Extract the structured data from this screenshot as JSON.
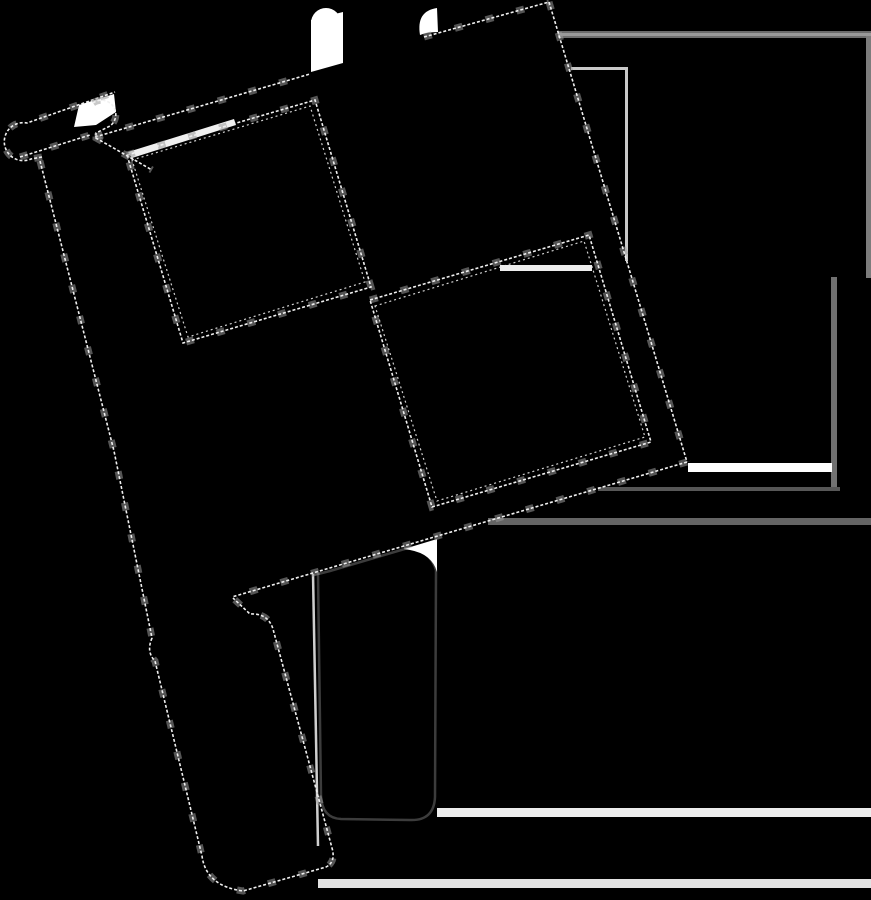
{
  "meta": {
    "description": "Black checkered racing flag icon silhouette on black background, tilted about 16 degrees, with pole, top clip, and two hanging straps; visible only via stepped light outlines, small white cutout blobs, thin light guide lines and gray background rules",
    "width": 871,
    "height": 900,
    "background": "#000000"
  },
  "icon": {
    "name": "checkered-flag",
    "fill": "#000000",
    "edge_fine_color": "#f0f0f0",
    "edge_block_color": "#9a9a9a",
    "strap_outline_color": "#3c3c3c",
    "tilt_degrees": 16.5
  },
  "shapes": [
    {
      "id": "background",
      "kind": "rect",
      "x": 0,
      "y": 0,
      "w": 871,
      "h": 900,
      "fill": "#000000"
    },
    {
      "id": "page-rule-top-dark",
      "kind": "rect",
      "x": 558,
      "y": 31,
      "w": 313,
      "h": 2,
      "fill": "#6b6b6b"
    },
    {
      "id": "page-rule-top-light",
      "kind": "rect",
      "x": 558,
      "y": 33,
      "w": 313,
      "h": 3,
      "fill": "#999999"
    },
    {
      "id": "page-rule-top-shade",
      "kind": "rect",
      "x": 558,
      "y": 36,
      "w": 313,
      "h": 2,
      "fill": "#6f6f6f"
    },
    {
      "id": "page-rule-right-upper",
      "kind": "rect",
      "x": 866,
      "y": 36,
      "w": 5,
      "h": 242,
      "fill": "#7c7c7c"
    },
    {
      "id": "page-rule-right-inner",
      "kind": "rect",
      "x": 831,
      "y": 277,
      "w": 6,
      "h": 213,
      "fill": "#717171"
    },
    {
      "id": "page-rule-bottom",
      "kind": "rect",
      "x": 488,
      "y": 518,
      "w": 383,
      "h": 7,
      "fill": "#646464"
    },
    {
      "id": "page-rule-inner-h",
      "kind": "rect",
      "x": 598,
      "y": 487,
      "w": 242,
      "h": 4,
      "fill": "#575757"
    },
    {
      "id": "page-stripe-upper",
      "kind": "rect",
      "x": 437,
      "y": 808,
      "w": 434,
      "h": 9,
      "fill": "#ededed"
    },
    {
      "id": "page-stripe-lower",
      "kind": "rect",
      "x": 318,
      "y": 879,
      "w": 553,
      "h": 9,
      "fill": "#e2e2e2"
    },
    {
      "id": "white-bar-right",
      "kind": "rect",
      "x": 688,
      "y": 463,
      "w": 144,
      "h": 9,
      "fill": "#ffffff"
    },
    {
      "id": "guide-line-vertical",
      "kind": "rect",
      "x": 625,
      "y": 68,
      "w": 3,
      "h": 193,
      "fill": "#c9c9c9"
    },
    {
      "id": "guide-line-horizontal",
      "kind": "rect",
      "x": 571,
      "y": 67,
      "w": 57,
      "h": 3,
      "fill": "#c9c9c9"
    },
    {
      "id": "checker-edge-streak",
      "kind": "rect",
      "x": 500,
      "y": 265,
      "w": 92,
      "h": 6,
      "fill": "#ededed"
    },
    {
      "id": "clip-gap-circle",
      "kind": "circle",
      "cx": 326,
      "cy": 23,
      "r": 15,
      "fill": "#ffffff"
    },
    {
      "id": "clip-gap-tail",
      "kind": "polygon",
      "points": "311,20 343,12 343,63 311,72",
      "fill": "#ffffff"
    },
    {
      "id": "clip-gap-crescent",
      "kind": "path",
      "d": "M 420 35 Q 416 11 437 8 L 438 32 Q 427 32 420 35 Z",
      "fill": "#ffffff"
    },
    {
      "id": "pole-top-gap",
      "kind": "polygon",
      "points": "74,127 79,105 114,94 116,112 96,125",
      "fill": "#ffffff"
    },
    {
      "id": "flag-top-edge-band",
      "kind": "polygon",
      "points": "128,152 234,119 236,125 132,158",
      "fill": "#f0f0f0"
    },
    {
      "id": "pole-and-strap-left",
      "kind": "path",
      "d": "M 40 160 L 114 450 L 152 638 Q 146 652 155 661 L 202 856 Q 206 886 243 891 L 326 867 Q 336 862 332 848 L 273 629 Q 268 613 250 614 L 233 598 L 105 135 Z",
      "fill": "#000000"
    },
    {
      "id": "strap-right",
      "kind": "path",
      "d": "M 318 574 L 321 796 Q 322 818 341 819 L 410 820 Q 434 821 435 797 L 436 570 Q 430 550 408 548 L 330 571 Z",
      "fill": "#000000",
      "stroke": "#3c3c3c",
      "strokeWidth": 2.5
    },
    {
      "id": "strap-right-left-edge-line",
      "kind": "path",
      "d": "M 313 574 L 318 846",
      "stroke": "#cfcfcf",
      "strokeWidth": 2.5,
      "fill": "none"
    },
    {
      "id": "strap-right-corner-gap",
      "kind": "path",
      "d": "M 404 549 L 437 539 L 437 572 Q 432 554 410 550 Z",
      "fill": "#ffffff"
    },
    {
      "id": "flag-top-edge-left",
      "kind": "edge",
      "d": "M 95 137 L 310 74"
    },
    {
      "id": "flag-top-edge-right",
      "kind": "edge",
      "d": "M 424 37 L 549 2"
    },
    {
      "id": "flag-right-edge",
      "kind": "edge",
      "d": "M 549 2 L 687 462"
    },
    {
      "id": "flag-bottom-edge",
      "kind": "edge",
      "d": "M 687 462 L 232 597"
    },
    {
      "id": "checker-square-upper",
      "kind": "edge",
      "d": "M 127 155 L 315 100 L 371 287 L 183 343 Z"
    },
    {
      "id": "checker-square-upper-inner",
      "kind": "edge-inner",
      "d": "M 132 160 L 310 106 L 365 282 L 188 337 Z"
    },
    {
      "id": "checker-square-lower",
      "kind": "edge",
      "d": "M 370 300 L 589 235 L 651 442 L 432 507 Z"
    },
    {
      "id": "checker-square-lower-inner",
      "kind": "edge-inner",
      "d": "M 375 306 L 584 241 L 645 437 L 437 501 Z"
    },
    {
      "id": "pole-strap-outline",
      "kind": "edge",
      "d": "M 40 161 L 114 451 L 152 638 Q 146 652 155 661 L 202 856 Q 206 886 243 891 L 326 867 Q 336 862 332 848 L 273 629 Q 268 613 250 614 L 233 598"
    },
    {
      "id": "crossbar-cap-outline",
      "kind": "edge",
      "d": "M 42 157 L 31 159 A 19 19 0 1 1 27 123 L 115 92"
    },
    {
      "id": "crossbar-bottom-edge",
      "kind": "edge",
      "d": "M 20 157 L 90 135"
    },
    {
      "id": "crossbar-right-cap",
      "kind": "edge",
      "d": "M 93 103 A 14 14 0 0 1 110 126 L 96 133 L 96 138 L 152 170"
    }
  ]
}
